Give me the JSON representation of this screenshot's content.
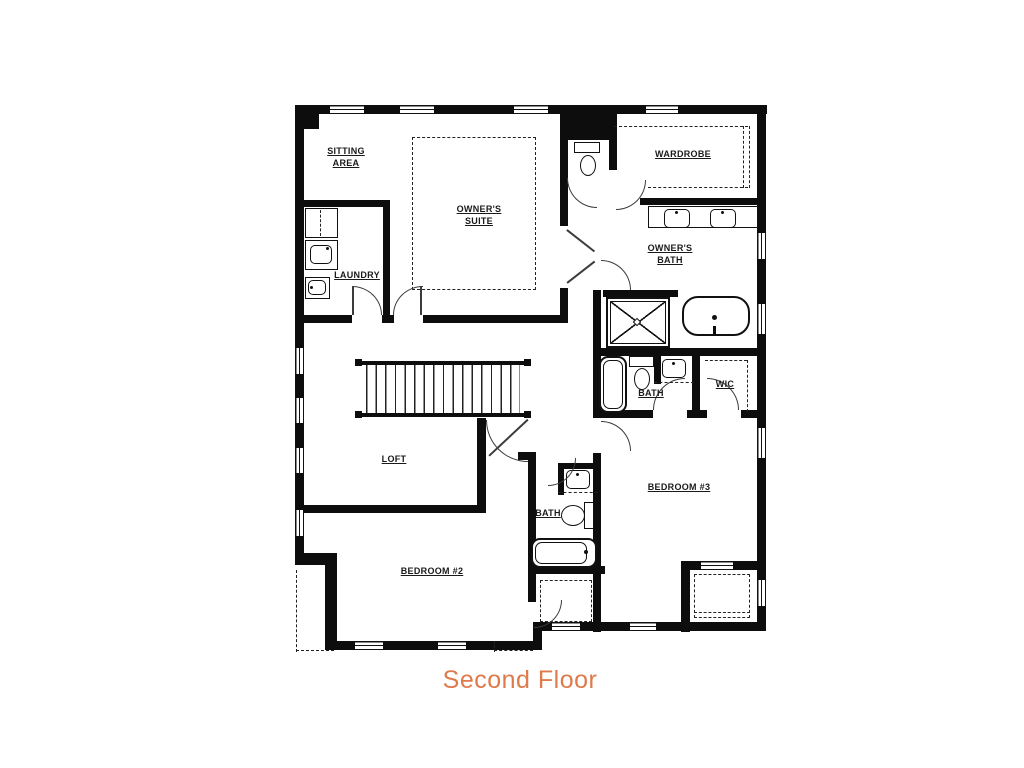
{
  "title": {
    "text": "Second Floor",
    "color": "#df7a4b"
  },
  "plan": {
    "line_color": "#111111",
    "background": "#ffffff"
  },
  "rooms": {
    "sitting_area": {
      "line1": "SITTING",
      "line2": "AREA"
    },
    "owners_suite": {
      "line1": "OWNER'S",
      "line2": "SUITE"
    },
    "laundry": {
      "label": "LAUNDRY"
    },
    "wardrobe": {
      "label": "WARDROBE"
    },
    "owners_bath": {
      "line1": "OWNER'S",
      "line2": "BATH"
    },
    "hall_bath": {
      "label": "BATH"
    },
    "wic": {
      "label": "WIC"
    },
    "bedroom3": {
      "label": "BEDROOM #3"
    },
    "loft": {
      "label": "LOFT"
    },
    "bath2": {
      "label": "BATH"
    },
    "bedroom2": {
      "label": "BEDROOM #2"
    }
  }
}
